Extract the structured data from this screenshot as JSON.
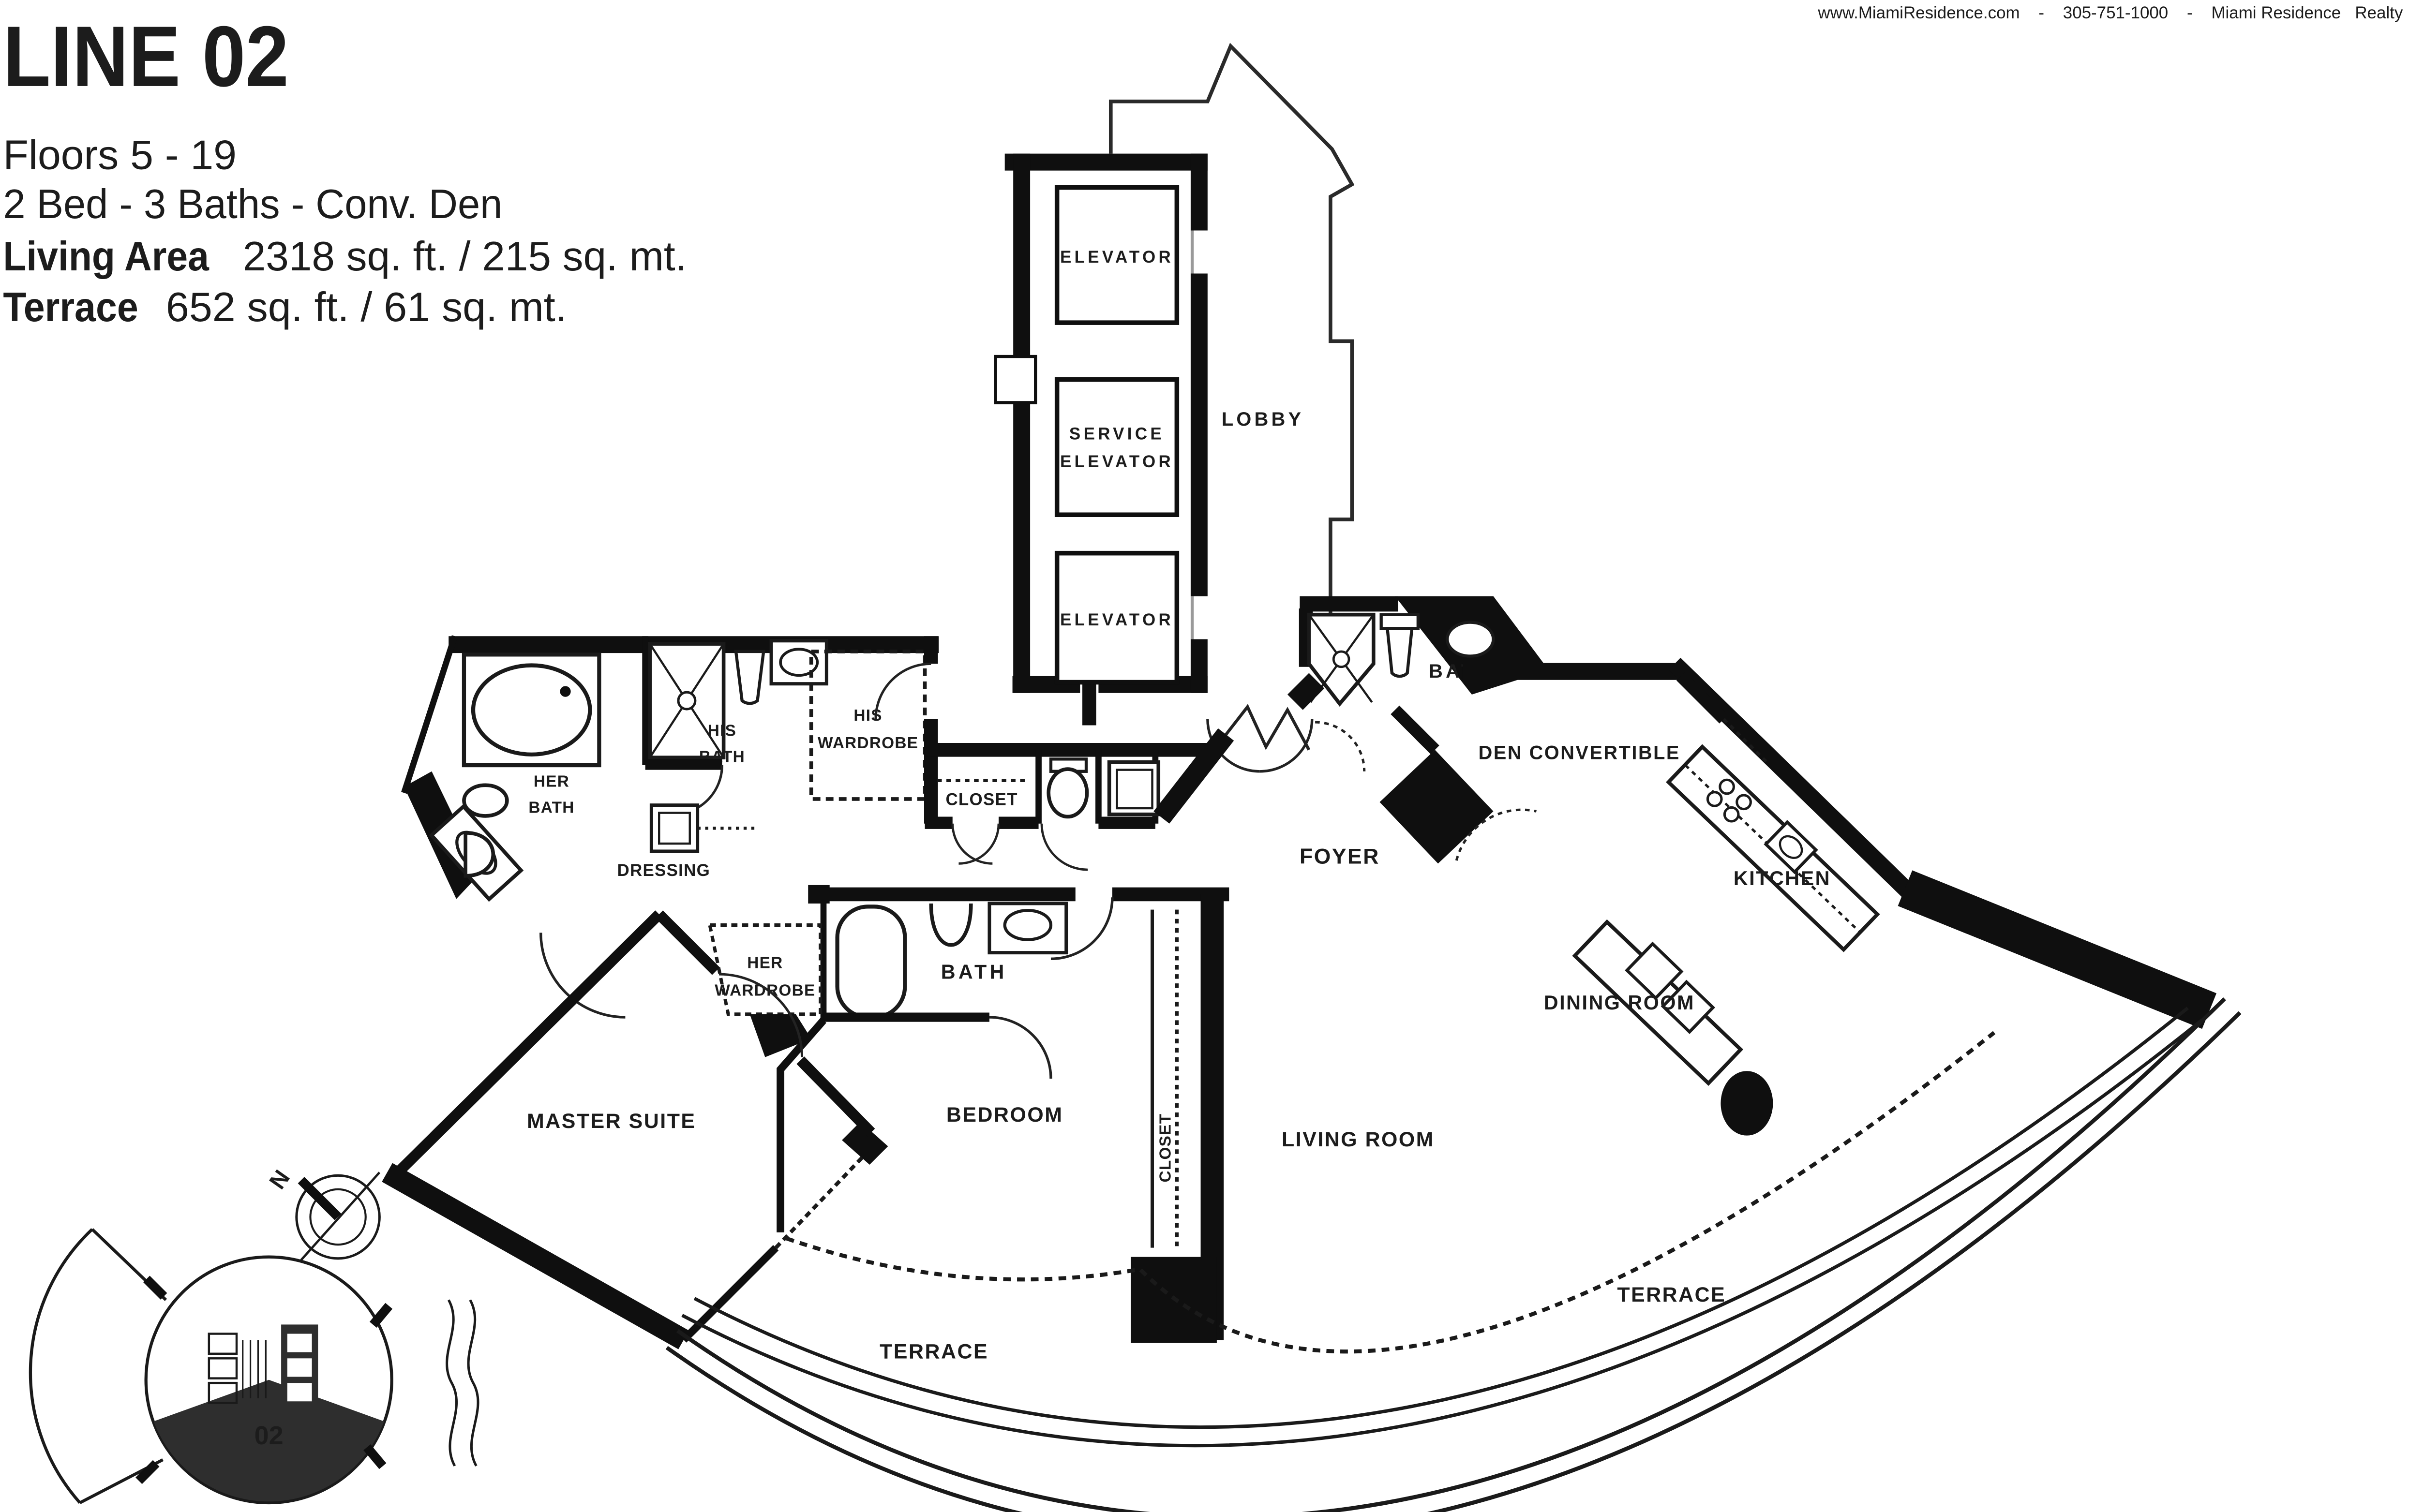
{
  "header": {
    "contact_line": "www.MiamiResidence.com    -    305-751-1000    -    Miami Residence   Realty"
  },
  "title": "LINE 02",
  "info": {
    "floors": "Floors 5 - 19",
    "beds": "2 Bed - 3 Baths - Conv. Den",
    "living_label": "Living Area",
    "living_value": "2318 sq. ft. / 215 sq. mt.",
    "terrace_label": "Terrace",
    "terrace_value": "652 sq. ft. / 61 sq. mt."
  },
  "plan": {
    "labels": {
      "elevator_top": "ELEVATOR",
      "service_line1": "SERVICE",
      "service_line2": "ELEVATOR",
      "elevator_bottom": "ELEVATOR",
      "lobby": "LOBBY",
      "bath_upper": "BATH",
      "den": "DEN CONVERTIBLE",
      "kitchen": "KITCHEN",
      "dining_room": "DINING ROOM",
      "living_room": "LIVING ROOM",
      "foyer": "FOYER",
      "closet": "CLOSET",
      "closet_bedroom": "CLOSET",
      "his_wardrobe_line1": "HIS",
      "his_wardrobe_line2": "WARDROBE",
      "his_bath_line1": "HIS",
      "his_bath_line2": "BATH",
      "her_bath_line1": "HER",
      "her_bath_line2": "BATH",
      "dressing": "DRESSING",
      "her_wardrobe_line1": "HER",
      "her_wardrobe_line2": "WARDROBE",
      "bath_bedroom": "BATH",
      "bedroom": "BEDROOM",
      "master_suite": "MASTER SUITE",
      "terrace_left": "TERRACE",
      "terrace_right": "TERRACE"
    }
  },
  "keyplan": {
    "unit": "02",
    "compass_north": "N"
  },
  "colors": {
    "wall": "#0f0f0f",
    "keyplan_dark": "#2e2e2e",
    "text": "#1c1c1c"
  }
}
